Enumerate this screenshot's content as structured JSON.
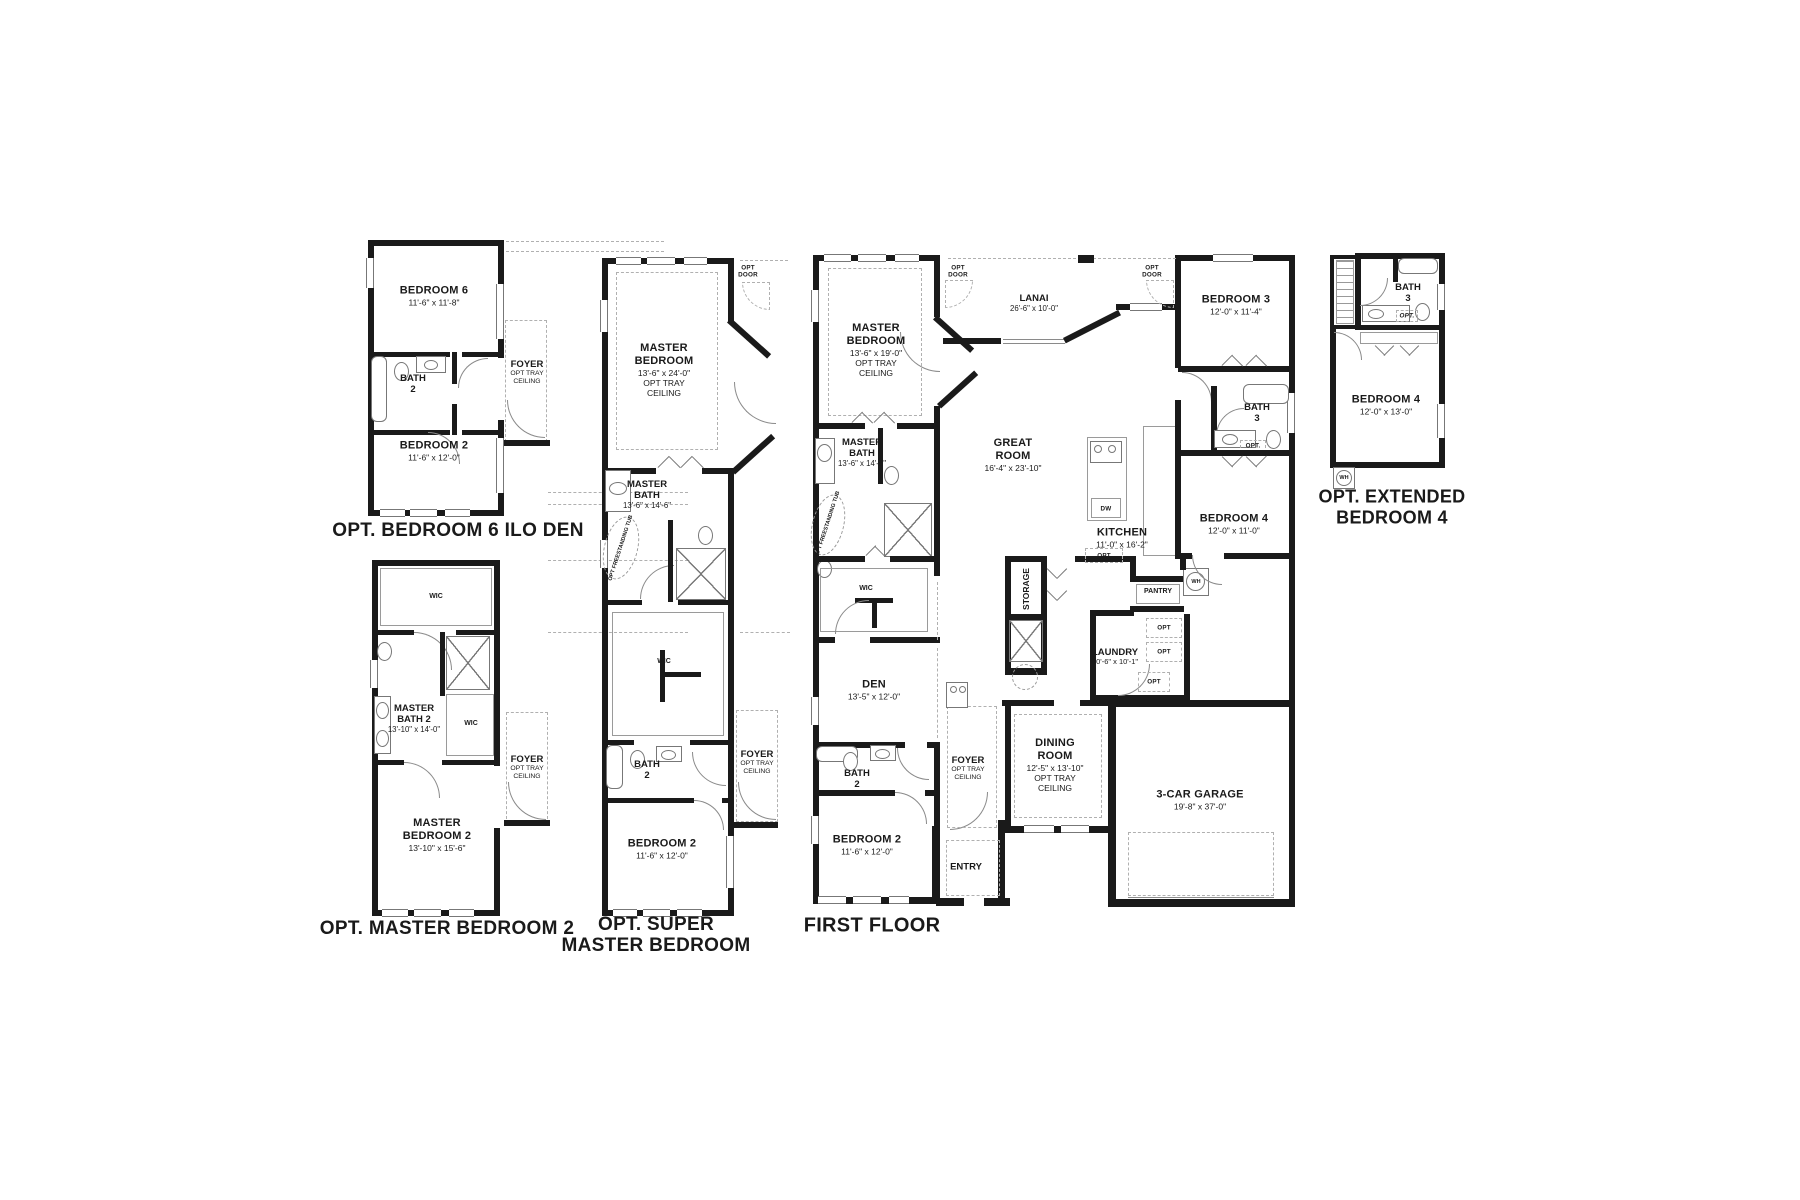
{
  "page": {
    "background": "#ffffff",
    "wall_color": "#1a1a1a",
    "line_color": "#8a8a8a"
  },
  "plans": {
    "a": {
      "title": "OPT. BEDROOM 6 ILO DEN",
      "bedroom6": {
        "name": "BEDROOM 6",
        "dims": "11'-6\" x 11'-8\""
      },
      "bath2": {
        "name": "BATH 2"
      },
      "foyer": {
        "name": "FOYER",
        "sub": "OPT TRAY CEILING"
      },
      "bedroom2": {
        "name": "BEDROOM 2",
        "dims": "11'-6\" x 12'-0\""
      }
    },
    "b": {
      "title": "OPT. MASTER BEDROOM 2",
      "wic1": {
        "name": "WIC"
      },
      "master_bath2": {
        "name": "MASTER BATH 2",
        "dims": "13'-10\" x 14'-0\""
      },
      "wic2": {
        "name": "WIC"
      },
      "foyer": {
        "name": "FOYER",
        "sub": "OPT TRAY CEILING"
      },
      "master_bedroom2": {
        "name": "MASTER BEDROOM 2",
        "dims": "13'-10\" x 15'-6\""
      }
    },
    "c": {
      "title_line1": "OPT. SUPER",
      "title_line2": "MASTER BEDROOM",
      "master_bedroom": {
        "name": "MASTER BEDROOM",
        "dims": "13'-6\" x 24'-0\"",
        "sub": "OPT TRAY CEILING"
      },
      "opt_door": "OPT DOOR",
      "master_bath": {
        "name": "MASTER BATH",
        "dims": "13'-6\" x 14'-6\""
      },
      "opt_tub": "OPT FREESTANDING TUB",
      "wic": {
        "name": "WIC"
      },
      "bath2": {
        "name": "BATH 2"
      },
      "foyer": {
        "name": "FOYER",
        "sub": "OPT TRAY CEILING"
      },
      "bedroom2": {
        "name": "BEDROOM 2",
        "dims": "11'-6\" x 12'-0\""
      }
    },
    "f": {
      "title": "FIRST FLOOR",
      "master_bedroom": {
        "name": "MASTER BEDROOM",
        "dims": "13'-6\" x 19'-0\"",
        "sub": "OPT TRAY CEILING"
      },
      "opt_door_left": "OPT DOOR",
      "opt_door_right": "OPT DOOR",
      "lanai": {
        "name": "LANAI",
        "dims": "26'-6\" x 10'-0\""
      },
      "bedroom3": {
        "name": "BEDROOM 3",
        "dims": "12'-0\" x 11'-4\""
      },
      "great_room": {
        "name": "GREAT ROOM",
        "dims": "16'-4\" x 23'-10\""
      },
      "master_bath": {
        "name": "MASTER BATH",
        "dims": "13'-6\" x 14'-6\""
      },
      "opt_tub": "OPT FREESTANDING TUB",
      "wic": {
        "name": "WIC"
      },
      "bath3": {
        "name": "BATH 3",
        "opt": "OPT."
      },
      "bedroom4": {
        "name": "BEDROOM 4",
        "dims": "12'-0\" x 11'-0\""
      },
      "kitchen": {
        "name": "KITCHEN",
        "dims": "11'-0\" x 16'-2\""
      },
      "dw": "DW",
      "storage": "STORAGE",
      "pantry": "PANTRY",
      "wh": "WH",
      "laundry": {
        "name": "LAUNDRY",
        "dims": "10'-6\" x 10'-1\""
      },
      "opt": "OPT",
      "den": {
        "name": "DEN",
        "dims": "13'-5\" x 12'-0\""
      },
      "dining": {
        "name": "DINING ROOM",
        "dims": "12'-5\" x 13'-10\"",
        "sub": "OPT TRAY CEILING"
      },
      "foyer": {
        "name": "FOYER",
        "sub": "OPT TRAY CEILING"
      },
      "bath2": {
        "name": "BATH 2"
      },
      "bedroom2": {
        "name": "BEDROOM 2",
        "dims": "11'-6\" x 12'-0\""
      },
      "entry": {
        "name": "ENTRY"
      },
      "garage": {
        "name": "3-CAR GARAGE",
        "dims": "19'-8\" x 37'-0\""
      }
    },
    "e": {
      "title_line1": "OPT. EXTENDED",
      "title_line2": "BEDROOM 4",
      "bath3": {
        "name": "BATH 3",
        "opt": "OPT."
      },
      "bedroom4": {
        "name": "BEDROOM 4",
        "dims": "12'-0\" x 13'-0\""
      },
      "wh": "WH"
    }
  }
}
